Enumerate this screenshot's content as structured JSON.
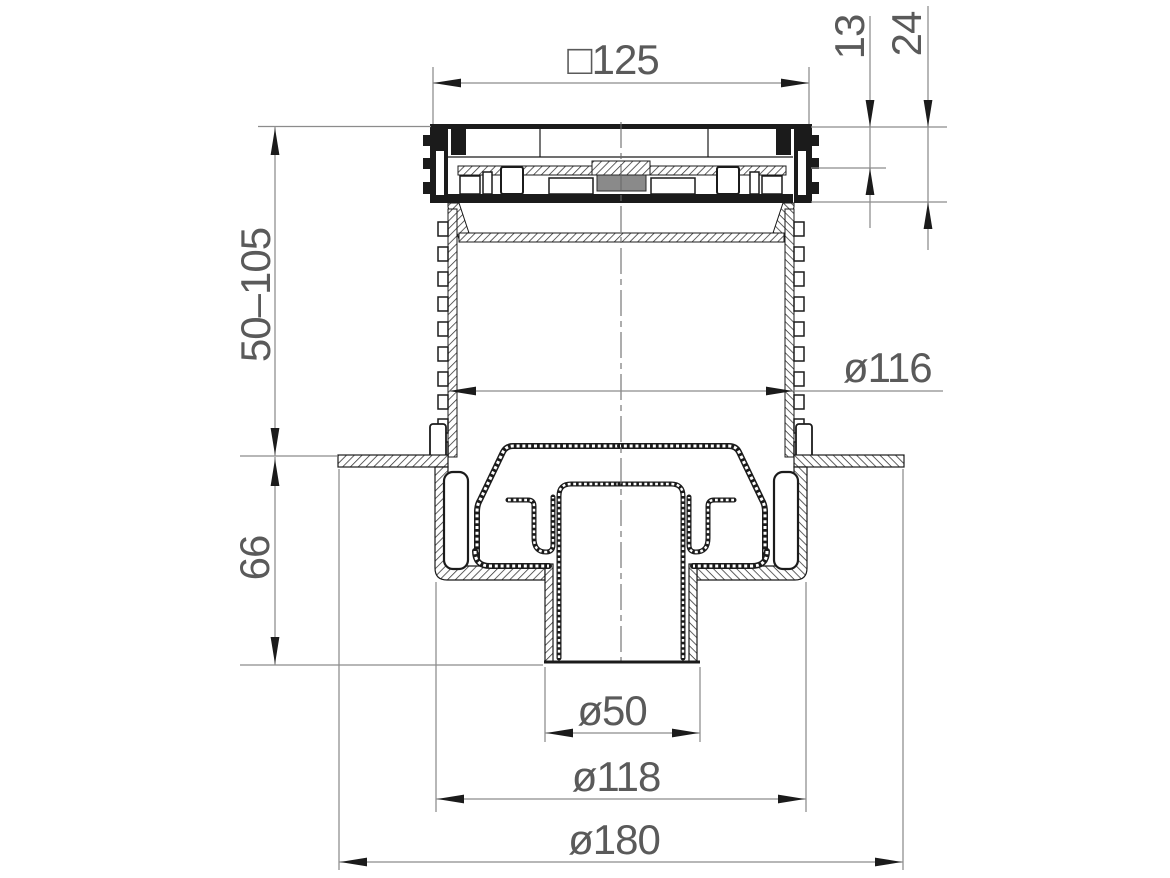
{
  "drawing": {
    "title": "Floor drain vertical-outlet cross-section technical drawing",
    "dimensions": {
      "grate_width": "□125",
      "grate_rim_height": "13",
      "frame_height": "24",
      "adjustment_range": "50–105",
      "riser_pipe_diameter": "ø116",
      "body_height": "66",
      "outlet_diameter": "ø50",
      "body_diameter": "ø118",
      "flange_diameter": "ø180"
    },
    "colors": {
      "line": "#1b1b1b",
      "dimension": "#8c8c8c",
      "text": "#5a5a5a",
      "background": "#ffffff"
    }
  }
}
